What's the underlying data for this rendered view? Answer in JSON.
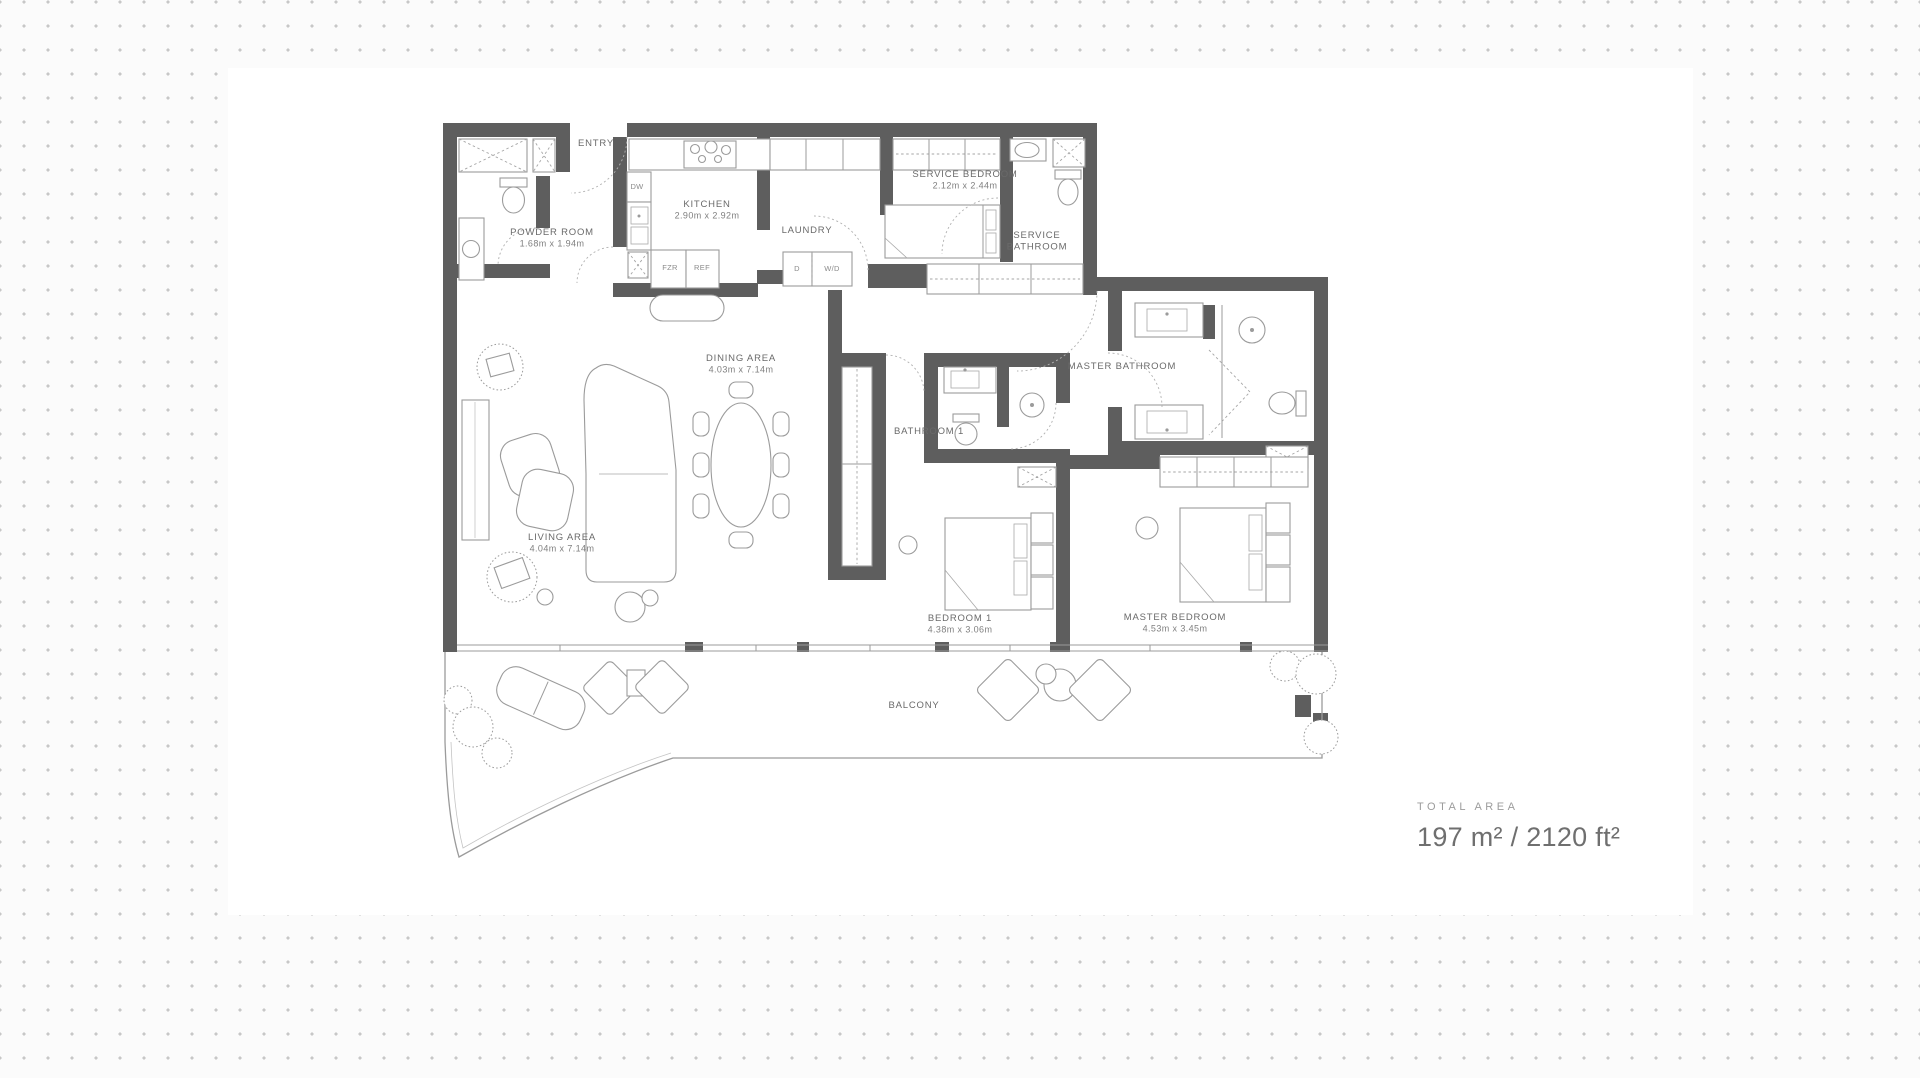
{
  "plan": {
    "wall_color": "#5e5e5e",
    "rooms": [
      {
        "id": "entry",
        "label": "ENTRY",
        "dims": "",
        "x": 596,
        "y": 146
      },
      {
        "id": "powder-room",
        "label": "POWDER ROOM",
        "dims": "1.68m x 1.94m",
        "x": 552,
        "y": 235
      },
      {
        "id": "kitchen",
        "label": "KITCHEN",
        "dims": "2.90m x 2.92m",
        "x": 707,
        "y": 207
      },
      {
        "id": "laundry",
        "label": "LAUNDRY",
        "dims": "",
        "x": 807,
        "y": 233
      },
      {
        "id": "service-bedroom",
        "label": "SERVICE BEDROOM",
        "dims": "2.12m x 2.44m",
        "x": 965,
        "y": 177
      },
      {
        "id": "service-bathroom",
        "label": "SERVICE\nBATHROOM",
        "dims": "",
        "x": 1037,
        "y": 238
      },
      {
        "id": "dining-area",
        "label": "DINING AREA",
        "dims": "4.03m x 7.14m",
        "x": 741,
        "y": 361
      },
      {
        "id": "master-bathroom",
        "label": "MASTER BATHROOM",
        "dims": "",
        "x": 1122,
        "y": 369
      },
      {
        "id": "bathroom-1",
        "label": "BATHROOM 1",
        "dims": "",
        "x": 929,
        "y": 434
      },
      {
        "id": "living-area",
        "label": "LIVING AREA",
        "dims": "4.04m x 7.14m",
        "x": 562,
        "y": 540
      },
      {
        "id": "bedroom-1",
        "label": "BEDROOM 1",
        "dims": "4.38m x 3.06m",
        "x": 960,
        "y": 621
      },
      {
        "id": "master-bedroom",
        "label": "MASTER BEDROOM",
        "dims": "4.53m x 3.45m",
        "x": 1175,
        "y": 620
      },
      {
        "id": "balcony",
        "label": "BALCONY",
        "dims": "",
        "x": 914,
        "y": 708
      }
    ],
    "appliances": [
      {
        "id": "dishwasher",
        "label": "DW",
        "x": 637,
        "y": 189
      },
      {
        "id": "freezer",
        "label": "FZR",
        "x": 670,
        "y": 270
      },
      {
        "id": "refrigerator",
        "label": "REF",
        "x": 702,
        "y": 270
      },
      {
        "id": "dryer",
        "label": "D",
        "x": 797,
        "y": 271
      },
      {
        "id": "washer-dryer",
        "label": "W/D",
        "x": 832,
        "y": 271
      }
    ]
  },
  "total_area": {
    "label": "TOTAL AREA",
    "value": "197 m² / 2120 ft²"
  }
}
